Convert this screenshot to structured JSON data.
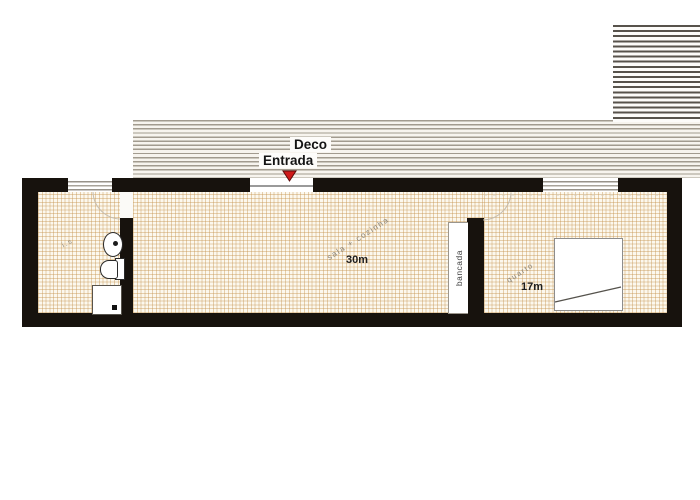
{
  "deck": {
    "label": "Deco"
  },
  "entrance": {
    "label": "Entrada"
  },
  "rooms": {
    "bathroom": {
      "label": "i.s"
    },
    "living_kitchen": {
      "name": "sala + cozinha",
      "area": "30m"
    },
    "bedroom": {
      "name": "quarto",
      "area": "17m"
    }
  },
  "fixtures": {
    "counter_label": "bancada"
  },
  "colors": {
    "wall": "#17120d",
    "entrance_marker": "#cf1a1a",
    "floor_line": "#c89558",
    "deck_stripe": "#a29b8f",
    "dense_stripe": "#57524b"
  }
}
